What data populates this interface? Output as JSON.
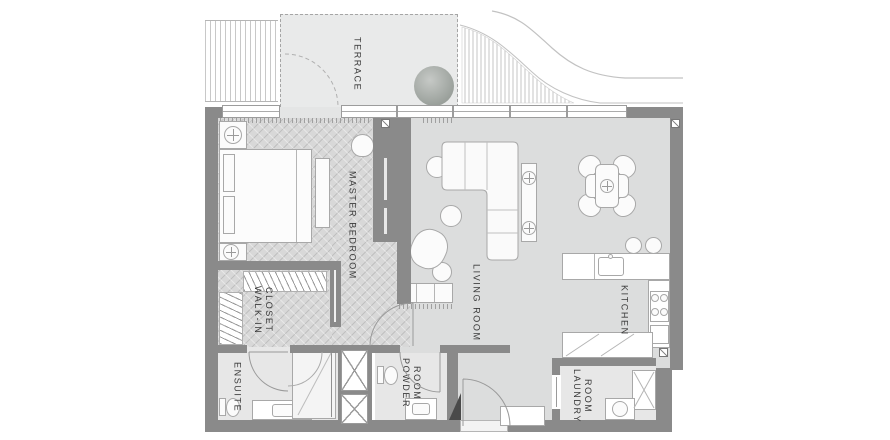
{
  "plan_title": "apartment-floor-plan",
  "colors": {
    "wall": "#8a8a8a",
    "floor-wood": "#d8d8d8",
    "floor-living": "#dcdddd",
    "floor-bath": "#e7e7e7",
    "floor-terrace": "#e9eaea",
    "outline": "#a8a8a8",
    "label": "#3a3a3a"
  },
  "rooms": {
    "terrace": {
      "label": "TERRACE"
    },
    "master_bedroom": {
      "label": "MASTER BEDROOM"
    },
    "walk_in_closet": {
      "label": "WALK-IN\nCLOSET"
    },
    "ensuite": {
      "label": "ENSUITE"
    },
    "powder_room": {
      "label": "POWDER\nROOM"
    },
    "living_room": {
      "label": "LIVING ROOM"
    },
    "kitchen": {
      "label": "KITCHEN"
    },
    "laundry_room": {
      "label": "LAUNDRY\nROOM"
    }
  }
}
